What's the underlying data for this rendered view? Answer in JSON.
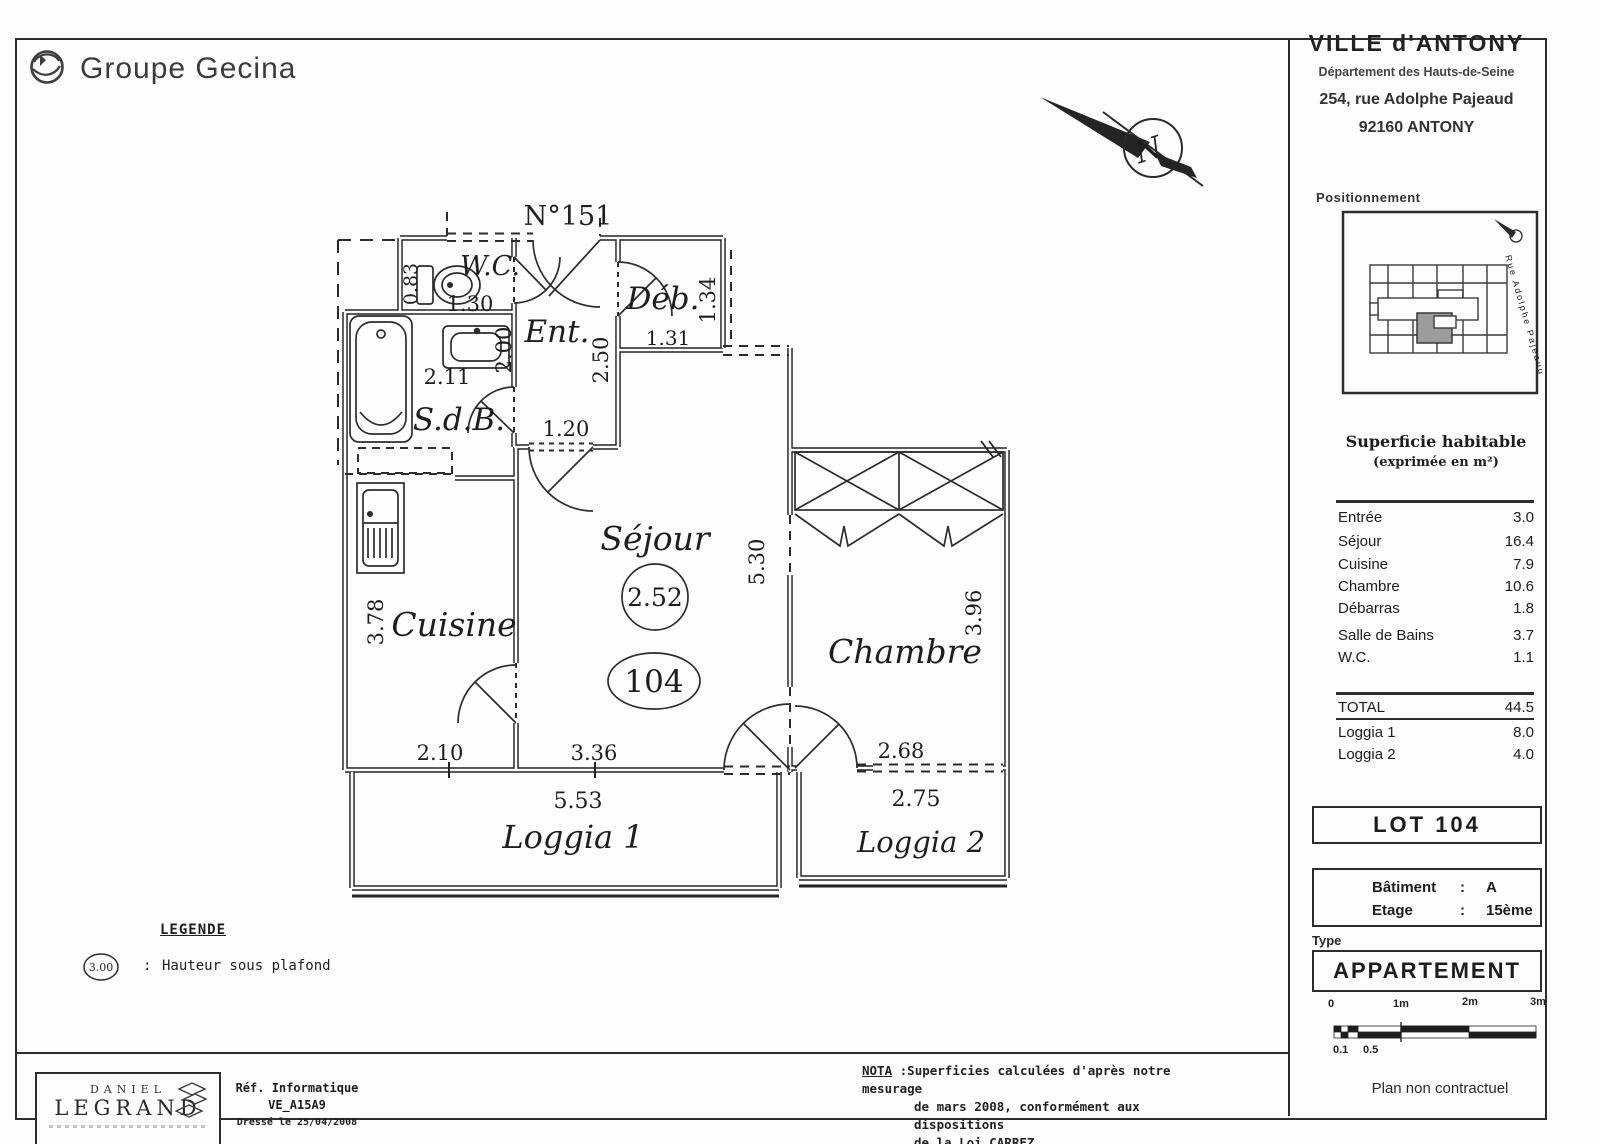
{
  "header": {
    "brand": "Groupe Gecina",
    "address": {
      "city": "VILLE d'ANTONY",
      "department": "Département des Hauts-de-Seine",
      "street": "254, rue Adolphe Pajeaud",
      "postal": "92160 ANTONY"
    }
  },
  "compass": {
    "letter": "N"
  },
  "positioning": {
    "label": "Positionnement",
    "street_label": "Rue Adolphe Pajeaud"
  },
  "areas": {
    "title": "Superficie habitable",
    "subtitle": "(exprimée en m²)",
    "rows": [
      {
        "label": "Entrée",
        "value": "3.0"
      },
      {
        "label": "Séjour",
        "value": "16.4"
      },
      {
        "label": "Cuisine",
        "value": "7.9"
      },
      {
        "label": "Chambre",
        "value": "10.6"
      },
      {
        "label": "Débarras",
        "value": "1.8"
      },
      {
        "label": "Salle de Bains",
        "value": "3.7"
      },
      {
        "label": "W.C.",
        "value": "1.1"
      }
    ],
    "total": {
      "label": "TOTAL",
      "value": "44.5"
    },
    "loggias": [
      {
        "label": "Loggia 1",
        "value": "8.0"
      },
      {
        "label": "Loggia 2",
        "value": "4.0"
      }
    ]
  },
  "lot": {
    "label": "LOT 104"
  },
  "building": {
    "batiment_label": "Bâtiment",
    "batiment_value": "A",
    "etage_label": "Etage",
    "colon": ":",
    "etage_value": "15ème"
  },
  "unit_type": {
    "label": "Type",
    "value": "APPARTEMENT"
  },
  "scalebar": {
    "t0": "0",
    "t1": "1m",
    "t2": "2m",
    "t3": "3m",
    "b1": "0.1",
    "b2": "0.5"
  },
  "disclaimer": "Plan non contractuel",
  "legend": {
    "title": "LEGENDE",
    "symbol": "3.00",
    "colon": ":",
    "text": "Hauteur sous plafond"
  },
  "nota": {
    "label": "NOTA",
    "line1": ":Superficies calculées d'après notre mesurage",
    "line2": "de mars 2008, conformément aux dispositions",
    "line3": "de la Loi CARREZ."
  },
  "footer": {
    "firm_top": "DANIEL",
    "firm_bottom": "LEGRAND",
    "ref_label": "Réf. Informatique",
    "ref_value": "VE_A15A9",
    "date": "Dressé le 25/04/2008"
  },
  "plan": {
    "unit_number": "N°151",
    "rooms": {
      "wc": "W.C.",
      "ent": "Ent.",
      "deb": "Déb.",
      "sdb": "S.d.B.",
      "cuisine": "Cuisine",
      "sejour": "Séjour",
      "chambre": "Chambre",
      "loggia1": "Loggia 1",
      "loggia2": "Loggia 2"
    },
    "dims": {
      "wc_width": "1.30",
      "wc_depth": "0.83",
      "sdb_width": "2.11",
      "sdb_depth": "2.00",
      "ent_depth": "2.50",
      "ent_width": "1.20",
      "deb_width": "1.31",
      "deb_depth": "1.34",
      "cuisine_depth": "3.78",
      "cuisine_width": "2.10",
      "sejour_width": "3.36",
      "sejour_depth": "5.30",
      "chambre_width": "2.68",
      "chambre_depth": "3.96",
      "loggia1_width": "5.53",
      "loggia2_width": "2.75"
    },
    "ceiling_height": "2.52",
    "lot_bubble": "104"
  }
}
